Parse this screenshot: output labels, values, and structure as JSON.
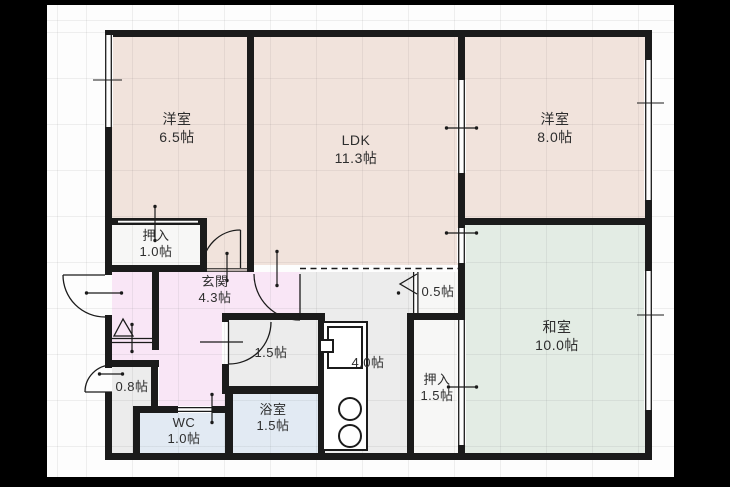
{
  "plan": {
    "type": "floor-plan",
    "unit": "帖",
    "colors": {
      "wall": "#1b1b1b",
      "western_room": "#f1e3dc",
      "japanese_room": "#e3ece4",
      "entrance": "#f9e6f6",
      "wet_area": "#e2eaf3",
      "hall_kitchen": "#ececec",
      "closet": "#f7f7f6",
      "background": "#000000",
      "paper": "#fdfdfd"
    }
  },
  "rooms": {
    "western1": {
      "name": "洋室",
      "size": "6.5帖"
    },
    "ldk": {
      "name": "LDK",
      "size": "11.3帖"
    },
    "western2": {
      "name": "洋室",
      "size": "8.0帖"
    },
    "japanese": {
      "name": "和室",
      "size": "10.0帖"
    },
    "closet1": {
      "name": "押入",
      "size": "1.0帖"
    },
    "entrance": {
      "name": "玄関",
      "size": "4.3帖"
    },
    "closet05": {
      "size": "0.5帖"
    },
    "washroom": {
      "size": "1.5帖"
    },
    "storage08": {
      "size": "0.8帖"
    },
    "wc": {
      "name": "WC",
      "size": "1.0帖"
    },
    "bath": {
      "name": "浴室",
      "size": "1.5帖"
    },
    "kitchen": {
      "size": "4.0帖"
    },
    "closet2": {
      "name": "押入",
      "size": "1.5帖"
    }
  }
}
